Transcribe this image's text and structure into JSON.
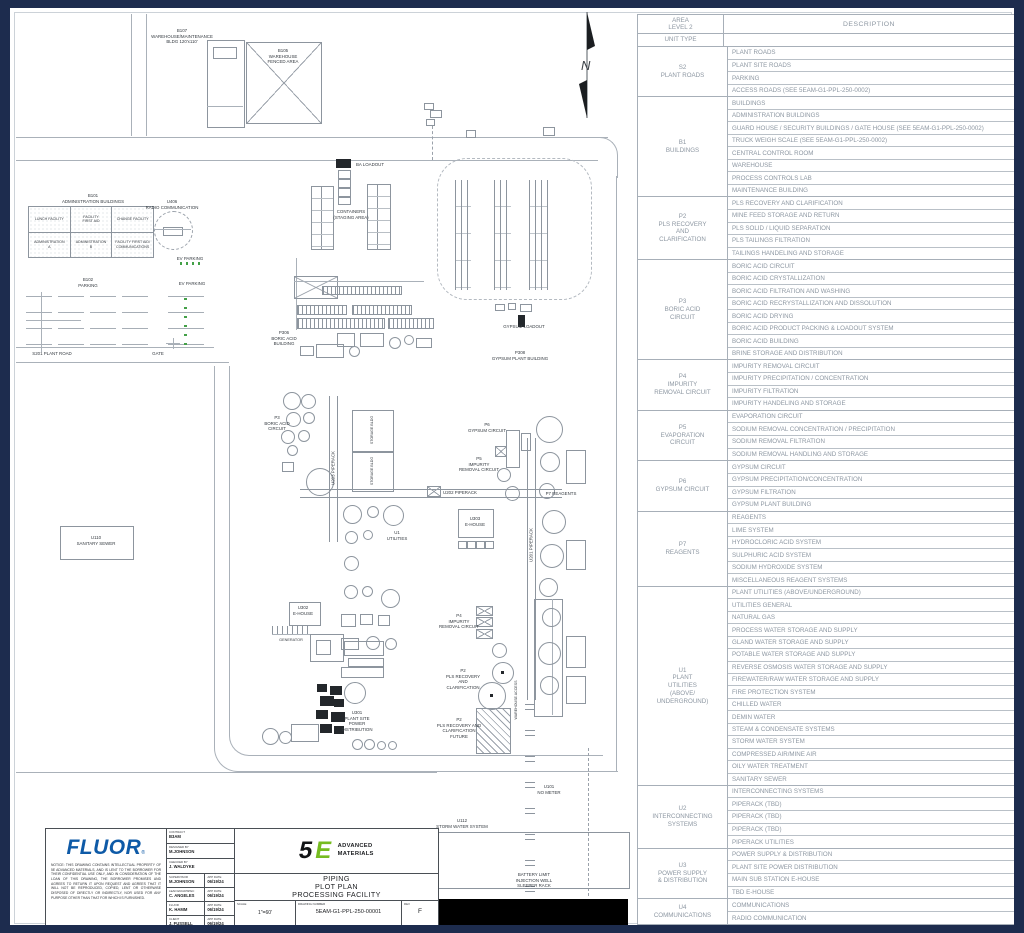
{
  "north_label": "N",
  "colors": {
    "frame_navy": "#1d2c4e",
    "fluor_blue": "#0e5aa7",
    "logo_green": "#76bc20",
    "ev_green": "#43a047",
    "table_gray": "#8d97a2"
  },
  "legend_table": {
    "header": {
      "area": "AREA\nLEVEL 2",
      "unit_type": "UNIT TYPE",
      "description": "DESCRIPTION"
    },
    "groups": [
      {
        "area": "S2\nPLANT ROADS",
        "items": [
          "PLANT ROADS",
          "PLANT SITE ROADS",
          "PARKING",
          "ACCESS ROADS (SEE 5EAM-G1-PPL-250-0002)"
        ]
      },
      {
        "area": "B1\nBUILDINGS",
        "items": [
          "BUILDINGS",
          "ADMINISTRATION BUILDINGS",
          "GUARD HOUSE / SECURITY BUILDINGS / GATE HOUSE (SEE 5EAM-G1-PPL-250-0002)",
          "TRUCK WEIGH SCALE (SEE 5EAM-G1-PPL-250-0002)",
          "CENTRAL CONTROL ROOM",
          "WAREHOUSE",
          "PROCESS CONTROLS LAB",
          "MAINTENANCE BUILDING"
        ]
      },
      {
        "area": "P2\nPLS RECOVERY\nAND\nCLARIFICATION",
        "items": [
          "PLS RECOVERY AND CLARIFICATION",
          "MINE FEED STORAGE AND RETURN",
          "PLS SOLID / LIQUID SEPARATION",
          "PLS TAILINGS FILTRATION",
          "TAILINGS HANDELING AND STORAGE"
        ]
      },
      {
        "area": "P3\nBORIC ACID\nCIRCUIT",
        "items": [
          "BORIC ACID CIRCUIT",
          "BORIC ACID CRYSTALLIZATION",
          "BORIC ACID FILTRATION AND WASHING",
          "BORIC ACID RECRYSTALLIZATION AND DISSOLUTION",
          "BORIC ACID DRYING",
          "BORIC ACID PRODUCT PACKING & LOADOUT SYSTEM",
          "BORIC ACID BUILDING",
          "BRINE STORAGE AND DISTRIBUTION"
        ]
      },
      {
        "area": "P4\nIMPURITY\nREMOVAL CIRCUIT",
        "items": [
          "IMPURITY REMOVAL CIRCUIT",
          "IMPURITY PRECIPITATION / CONCENTRATION",
          "IMPURITY FILTRATION",
          "IMPURITY HANDELING AND STORAGE"
        ]
      },
      {
        "area": "P5\nEVAPORATION\nCIRCUIT",
        "items": [
          "EVAPORATION CIRCUIT",
          "SODIUM REMOVAL CONCENTRATION / PRECIPITATION",
          "SODIUM REMOVAL FILTRATION",
          "SODIUM REMOVAL HANDLING AND STORAGE"
        ]
      },
      {
        "area": "P6\nGYPSUM CIRCUIT",
        "items": [
          "GYPSUM CIRCUIT",
          "GYPSUM PRECIPITATION/CONCENTRATION",
          "GYPSUM FILTRATION",
          "GYPSUM PLANT BUILDING"
        ]
      },
      {
        "area": "P7\nREAGENTS",
        "items": [
          "REAGENTS",
          "LIME SYSTEM",
          "HYDROCLORIC ACID SYSTEM",
          "SULPHURIC ACID SYSTEM",
          "SODIUM HYDROXIDE SYSTEM",
          "MISCELLANEOUS REAGENT SYSTEMS"
        ]
      },
      {
        "area": "U1\nPLANT\nUTILITIES\n(ABOVE/\nUNDERGROUND)",
        "items": [
          "PLANT UTILITIES (ABOVE/UNDERGROUND)",
          "UTILITIES GENERAL",
          "NATURAL GAS",
          "PROCESS WATER STORAGE AND SUPPLY",
          "GLAND WATER STORAGE AND SUPPLY",
          "POTABLE WATER STORAGE AND SUPPLY",
          "REVERSE OSMOSIS WATER STORAGE AND SUPPLY",
          "FIREWATER/RAW WATER STORAGE AND SUPPLY",
          "FIRE PROTECTION SYSTEM",
          "CHILLED WATER",
          "DEMIN WATER",
          "STEAM & CONDENSATE SYSTEMS",
          "STORM WATER SYSTEM",
          "COMPRESSED AIR/MINE AIR",
          "OILY WATER TREATMENT",
          "SANITARY SEWER"
        ]
      },
      {
        "area": "U2\nINTERCONNECTING\nSYSTEMS",
        "items": [
          "INTERCONNECTING SYSTEMS",
          "PIPERACK (TBD)",
          "PIPERACK (TBD)",
          "PIPERACK (TBD)",
          "PIPERACK UTILITIES"
        ]
      },
      {
        "area": "U3\nPOWER SUPPLY\n& DISTRIBUTION",
        "items": [
          "POWER SUPPLY & DISTRIBUTION",
          "PLANT SITE POWER DISTRIBUTION",
          "MAIN SUB STATION E-HOUSE",
          "TBD E-HOUSE"
        ]
      },
      {
        "area": "U4\nCOMMUNICATIONS",
        "items": [
          "COMMUNICATIONS",
          "RADIO COMMUNICATION"
        ]
      }
    ]
  },
  "admin_building": {
    "rows": [
      [
        "LUNCH FACILITY",
        "FACILITY\nFIRST AID",
        "CHANGE FACILITY"
      ],
      [
        "ADMINISTRATION\nA",
        "ADMINISTRATION\nB",
        "FACILITY FIRST AID/\nCOMMUNICATIONS"
      ]
    ]
  },
  "drawing_labels": [
    {
      "t": "B107\nWAREHOUSE/MAINTENANCE\nBLDG 120'x110'",
      "x": 182,
      "y": 28
    },
    {
      "t": "B105\nWAREHOUSE\nFENCED AREA",
      "x": 283,
      "y": 48
    },
    {
      "t": "B101\nADMINISTRATION BUILDINGS",
      "x": 93,
      "y": 193
    },
    {
      "t": "U406\nRADIO COMMUNICATION",
      "x": 172,
      "y": 199
    },
    {
      "t": "EV PARKING",
      "x": 190,
      "y": 256
    },
    {
      "t": "B102\nPARKING",
      "x": 88,
      "y": 277
    },
    {
      "t": "EV PARKING",
      "x": 192,
      "y": 281
    },
    {
      "t": "S201 PLANT ROAD",
      "x": 52,
      "y": 351
    },
    {
      "t": "GATE",
      "x": 158,
      "y": 351
    },
    {
      "t": "BA LOADOUT",
      "x": 370,
      "y": 162
    },
    {
      "t": "CONTAINERS\n(STAGING AREA)",
      "x": 351,
      "y": 209
    },
    {
      "t": "GYPSUM LOADOUT",
      "x": 524,
      "y": 324
    },
    {
      "t": "P308\nGYPSUM PLANT BUILDING",
      "x": 520,
      "y": 350
    },
    {
      "t": "P306\nBORIC ACID\nBUILDING",
      "x": 284,
      "y": 330
    },
    {
      "t": "P3\nBORIC ACID\nCIRCUIT",
      "x": 277,
      "y": 415
    },
    {
      "t": "U203 PIPERACK",
      "x": 333,
      "y": 468,
      "r": 1
    },
    {
      "t": "U202 PIPERACK",
      "x": 460,
      "y": 490
    },
    {
      "t": "U201 PIPERACK",
      "x": 531,
      "y": 545,
      "r": 1
    },
    {
      "t": "P6\nGYPSUM CIRCUIT",
      "x": 487,
      "y": 422
    },
    {
      "t": "P5\nIMPURITY\nREMOVAL CIRCUIT",
      "x": 479,
      "y": 456
    },
    {
      "t": "U303\nE-HOUSE",
      "x": 475,
      "y": 516
    },
    {
      "t": "U1\nUTILITIES",
      "x": 397,
      "y": 530
    },
    {
      "t": "P7 REAGENTS",
      "x": 561,
      "y": 491
    },
    {
      "t": "STORAGE BLDG",
      "x": 372,
      "y": 430,
      "r": 1,
      "fs": 3.6
    },
    {
      "t": "STORAGE BLDG",
      "x": 372,
      "y": 471,
      "r": 1,
      "fs": 3.6
    },
    {
      "t": "U110\nSANITARY SEWER",
      "x": 96,
      "y": 535
    },
    {
      "t": "U302\nE-HOUSE",
      "x": 303,
      "y": 605
    },
    {
      "t": "GENERATOR",
      "x": 291,
      "y": 638,
      "fs": 3.8
    },
    {
      "t": "U301\nPLANT SITE\nPOWER\nDISTRIBUTION",
      "x": 357,
      "y": 710
    },
    {
      "t": "P4\nIMPURITY\nREMOVAL CIRCUIT",
      "x": 459,
      "y": 613
    },
    {
      "t": "P2\nPLS RECOVERY\nAND\nCLARIFICATION",
      "x": 463,
      "y": 668
    },
    {
      "t": "P2\nPLS RECOVERY AND\nCLARIFICATION\nFUTURE",
      "x": 459,
      "y": 717
    },
    {
      "t": "WAREHOUSE ACCESS",
      "x": 516,
      "y": 700,
      "r": 1,
      "fs": 3.6
    },
    {
      "t": "U101\nNO METER",
      "x": 549,
      "y": 784
    },
    {
      "t": "U112\nSTORM WATER SYSTEM",
      "x": 462,
      "y": 818
    },
    {
      "t": "BATTERY LIMIT\nINJECTION WELL\nSLEEPER RACK",
      "x": 534,
      "y": 872
    }
  ],
  "title_block": {
    "fluor_logo": "FLUOR",
    "fluor_reg": "®",
    "notice": "NOTICE: THIS DRAWING CONTAINS INTELLECTUAL PROPERTY OF 5E ADVANCED MATERIALS, AND IS LENT TO THE BORROWER FOR THEIR CONFIDENTIAL USE ONLY, AND IN CONSIDERATION OF THE LOAN OF THIS DRAWING, THE BORROWER PROMISES AND AGREES TO RETURN IT UPON REQUEST AND AGREES THAT IT WILL NOT BE REPRODUCED, COPIED, LENT OR OTHERWISE DISPOSED OF DIRECTLY OR INDIRECTLY, NOR USED FOR ANY PURPOSE OTHER THAN THAT FOR WHICH IS FURNISHED.",
    "fields": [
      {
        "label": "CONTRACT",
        "value": "B3AM"
      },
      {
        "label": "DESIGNED BY",
        "value": "M.JOHNSON"
      },
      {
        "label": "CHECKED BY",
        "value": "J. WALDYKE"
      }
    ],
    "signoffs": [
      {
        "label": "SUPERVISOR",
        "value": "M.JOHNSON",
        "date_label": "APP DATE",
        "date": "06/19/24"
      },
      {
        "label": "LEAD ENGR/SPEC",
        "value": "C. ANGELES",
        "date_label": "APP DATE",
        "date": "06/19/24"
      },
      {
        "label": "FLUOR",
        "value": "K. HAMM",
        "date_label": "APP DATE",
        "date": "06/19/24"
      },
      {
        "label": "CLIENT",
        "value": "J. FUSSELL",
        "date_label": "APP DATE",
        "date": "06/19/24"
      }
    ],
    "logo": {
      "five": "5",
      "e": "E",
      "company": "ADVANCED\nMATERIALS"
    },
    "title": "PIPING\nPLOT PLAN\nPROCESSING FACILITY",
    "scale_label": "SCALE",
    "scale": "1\"=60'",
    "drawing_number_label": "DRAWING NUMBER",
    "drawing_number": "5EAM-G1-PPL-250-00001",
    "rev_label": "REV",
    "rev": "F"
  }
}
